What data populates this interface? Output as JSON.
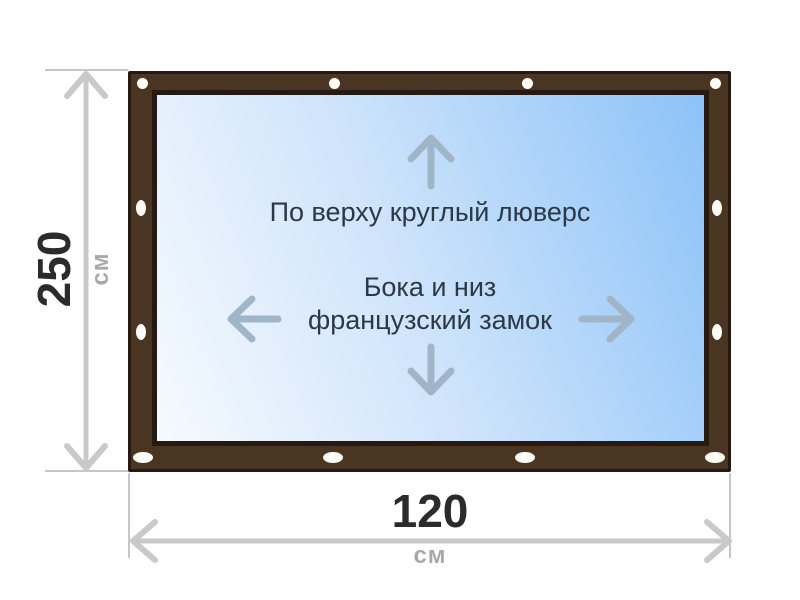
{
  "diagram": {
    "panel": {
      "top_note": "По верху круглый люверс",
      "middle_note_line1": "Бока и низ",
      "middle_note_line2": "французский замок"
    },
    "dimensions": {
      "height": {
        "value": "250",
        "unit": "см"
      },
      "width": {
        "value": "120",
        "unit": "см"
      }
    },
    "icons": {
      "round_grommet": "white circle fastener along top edge",
      "french_lock": "white oval fastener along sides and bottom",
      "direction_arrows": "up, down, left, right arrows inside panel",
      "dimension_arrows": "double-headed gray measurement arrows"
    }
  },
  "colors": {
    "background": "#ffffff",
    "frame_fill": "#4a3422",
    "frame_outline": "#251911",
    "panel_border": "#251911",
    "panel_grad_light": "#f6fafe",
    "panel_grad_mid": "#cfe4fb",
    "panel_grad_blue": "#8cc2f8",
    "note_text": "#2c3845",
    "panel_arrow": "#a0b5c8",
    "dim_line": "#c9c9c9",
    "ext_line": "#c6c6c6",
    "dim_value": "#2b2b2b",
    "dim_unit": "#a8a8a8",
    "grommet_fill": "#fffdf8"
  }
}
